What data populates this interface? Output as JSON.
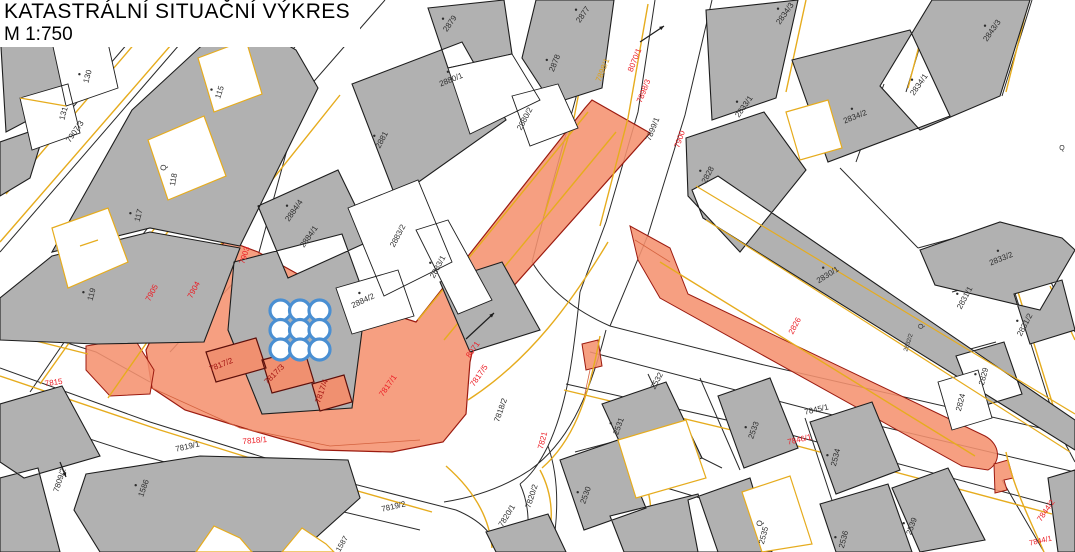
{
  "title": {
    "line1": "KATASTRÁLNÍ SITUAČNÍ VÝKRES",
    "line2": "M 1:750"
  },
  "colors": {
    "background": "#ffffff",
    "building_fill": "#b1b1b1",
    "parcel_line": "#2a2a2a",
    "boundary_yellow": "#e6ac1e",
    "highlight_fill": "#f5926f",
    "highlight_edge": "#9c1b10",
    "highlight_inner_line": "#d4623f",
    "label_black": "#2d2d2d",
    "label_red": "#ec1c24",
    "label_dark_red": "#a31311",
    "label_orange": "#dfa018",
    "symbol_blue": "#4a8fd2"
  },
  "map": {
    "labels": [
      {
        "t": "130",
        "x": 90,
        "y": 77,
        "r": -75,
        "c": "k",
        "d": 1
      },
      {
        "t": "131",
        "x": 66,
        "y": 114,
        "r": -75,
        "c": "k"
      },
      {
        "t": "7907/3",
        "x": 77,
        "y": 133,
        "r": -55,
        "c": "k"
      },
      {
        "t": "115",
        "x": 222,
        "y": 93,
        "r": -72,
        "c": "k",
        "d": 1
      },
      {
        "t": "Q",
        "x": 166,
        "y": 168,
        "r": -80,
        "c": "k"
      },
      {
        "t": "118",
        "x": 176,
        "y": 180,
        "r": -80,
        "c": "k"
      },
      {
        "t": "117",
        "x": 141,
        "y": 216,
        "r": -75,
        "c": "k",
        "d": 1
      },
      {
        "t": "119",
        "x": 94,
        "y": 295,
        "r": -75,
        "c": "k",
        "d": 1
      },
      {
        "t": "2879",
        "x": 452,
        "y": 25,
        "r": -55,
        "c": "k",
        "d": 1
      },
      {
        "t": "2877",
        "x": 585,
        "y": 16,
        "r": -55,
        "c": "k",
        "d": 1
      },
      {
        "t": "2878",
        "x": 557,
        "y": 64,
        "r": -68,
        "c": "k",
        "d": 1
      },
      {
        "t": "2880/1",
        "x": 452,
        "y": 82,
        "r": -22,
        "c": "k",
        "d": 1
      },
      {
        "t": "2880/2",
        "x": 527,
        "y": 120,
        "r": -62,
        "c": "k"
      },
      {
        "t": "2881",
        "x": 384,
        "y": 141,
        "r": -62,
        "c": "k",
        "d": 1
      },
      {
        "t": "2884/4",
        "x": 296,
        "y": 212,
        "r": -55,
        "c": "k",
        "d": 1
      },
      {
        "t": "2884/1",
        "x": 311,
        "y": 238,
        "r": -55,
        "c": "k"
      },
      {
        "t": "2883/2",
        "x": 400,
        "y": 237,
        "r": -62,
        "c": "k"
      },
      {
        "t": "2883/1",
        "x": 440,
        "y": 268,
        "r": -62,
        "c": "k",
        "d": 1
      },
      {
        "t": "2884/2",
        "x": 364,
        "y": 303,
        "r": -25,
        "c": "k",
        "d": 1
      },
      {
        "t": "7899/1",
        "x": 655,
        "y": 130,
        "r": -68,
        "c": "k"
      },
      {
        "t": "2834/3",
        "x": 787,
        "y": 15,
        "r": -55,
        "c": "k",
        "d": 1
      },
      {
        "t": "2833/1",
        "x": 746,
        "y": 108,
        "r": -55,
        "c": "k",
        "d": 1
      },
      {
        "t": "2834/2",
        "x": 856,
        "y": 119,
        "r": -22,
        "c": "k",
        "d": 1
      },
      {
        "t": "2834/1",
        "x": 921,
        "y": 86,
        "r": -55,
        "c": "k",
        "d": 1
      },
      {
        "t": "2843/3",
        "x": 994,
        "y": 32,
        "r": -55,
        "c": "k",
        "d": 1
      },
      {
        "t": "2828",
        "x": 710,
        "y": 176,
        "r": -62,
        "c": "k",
        "d": 1
      },
      {
        "t": "2830/1",
        "x": 829,
        "y": 277,
        "r": -32,
        "c": "k",
        "d": 1
      },
      {
        "t": "2833/2",
        "x": 1002,
        "y": 261,
        "r": -22,
        "c": "k",
        "d": 1
      },
      {
        "t": "2831/1",
        "x": 967,
        "y": 299,
        "r": -62,
        "c": "k",
        "d": 1
      },
      {
        "t": "2831/2",
        "x": 1027,
        "y": 326,
        "r": -62,
        "c": "k",
        "d": 1
      },
      {
        "t": "Q",
        "x": 923,
        "y": 327,
        "r": -72,
        "c": "k",
        "s": 7
      },
      {
        "t": "2832/2",
        "x": 910,
        "y": 343,
        "r": -72,
        "c": "k",
        "s": 6
      },
      {
        "t": "2829",
        "x": 986,
        "y": 377,
        "r": -75,
        "c": "k",
        "d": 1
      },
      {
        "t": "2824",
        "x": 963,
        "y": 403,
        "r": -75,
        "c": "k"
      },
      {
        "t": "Q",
        "x": 1062,
        "y": 150,
        "r": 0,
        "c": "k",
        "s": 7
      },
      {
        "t": "7845/1",
        "x": 817,
        "y": 412,
        "r": -13,
        "c": "k"
      },
      {
        "t": "2534",
        "x": 838,
        "y": 458,
        "r": -75,
        "c": "k",
        "d": 1
      },
      {
        "t": "Q",
        "x": 762,
        "y": 524,
        "r": -75,
        "c": "k"
      },
      {
        "t": "2535",
        "x": 766,
        "y": 536,
        "r": -75,
        "c": "k"
      },
      {
        "t": "2536",
        "x": 846,
        "y": 540,
        "r": -75,
        "c": "k",
        "d": 1
      },
      {
        "t": "2539",
        "x": 914,
        "y": 527,
        "r": -70,
        "c": "k",
        "d": 1
      },
      {
        "t": "2533",
        "x": 756,
        "y": 431,
        "r": -70,
        "c": "k",
        "d": 1
      },
      {
        "t": "2532",
        "x": 659,
        "y": 382,
        "r": -62,
        "c": "k"
      },
      {
        "t": "2531",
        "x": 621,
        "y": 427,
        "r": -70,
        "c": "k",
        "d": 1
      },
      {
        "t": "2530",
        "x": 588,
        "y": 496,
        "r": -70,
        "c": "k",
        "d": 1
      },
      {
        "t": "7818/2",
        "x": 503,
        "y": 411,
        "r": -70,
        "c": "k"
      },
      {
        "t": "7820/1",
        "x": 509,
        "y": 517,
        "r": -58,
        "c": "k"
      },
      {
        "t": "7820/2",
        "x": 534,
        "y": 497,
        "r": -72,
        "c": "k"
      },
      {
        "t": "7819/1",
        "x": 188,
        "y": 449,
        "r": -13,
        "c": "k"
      },
      {
        "t": "7819/2",
        "x": 394,
        "y": 509,
        "r": -13,
        "c": "k"
      },
      {
        "t": "7809/2",
        "x": 62,
        "y": 481,
        "r": -72,
        "c": "k"
      },
      {
        "t": "1586",
        "x": 146,
        "y": 489,
        "r": -70,
        "c": "k",
        "d": 1
      },
      {
        "t": "1587",
        "x": 344,
        "y": 545,
        "r": -60,
        "c": "k",
        "s": 7.5
      },
      {
        "t": "7903",
        "x": 247,
        "y": 256,
        "r": -72,
        "c": "r"
      },
      {
        "t": "7904",
        "x": 196,
        "y": 291,
        "r": -62,
        "c": "r"
      },
      {
        "t": "7905",
        "x": 154,
        "y": 294,
        "r": -62,
        "c": "r"
      },
      {
        "t": "7815",
        "x": 54,
        "y": 385,
        "r": -8,
        "c": "r"
      },
      {
        "t": "7818/1",
        "x": 255,
        "y": 443,
        "r": -5,
        "c": "r"
      },
      {
        "t": "7898/3",
        "x": 646,
        "y": 92,
        "r": -68,
        "c": "r"
      },
      {
        "t": "8070/1",
        "x": 637,
        "y": 61,
        "r": -68,
        "c": "r"
      },
      {
        "t": "7900",
        "x": 682,
        "y": 140,
        "r": -70,
        "c": "r"
      },
      {
        "t": "8071",
        "x": 475,
        "y": 351,
        "r": -55,
        "c": "r"
      },
      {
        "t": "7817/5",
        "x": 481,
        "y": 377,
        "r": -55,
        "c": "r"
      },
      {
        "t": "7817/1",
        "x": 390,
        "y": 387,
        "r": -55,
        "c": "r"
      },
      {
        "t": "7821",
        "x": 545,
        "y": 441,
        "r": -75,
        "c": "r"
      },
      {
        "t": "2826",
        "x": 797,
        "y": 327,
        "r": -62,
        "c": "r"
      },
      {
        "t": "7846/1",
        "x": 800,
        "y": 442,
        "r": -13,
        "c": "r"
      },
      {
        "t": "7844/2",
        "x": 1048,
        "y": 512,
        "r": -55,
        "c": "r"
      },
      {
        "t": "7844/1",
        "x": 1041,
        "y": 543,
        "r": -13,
        "c": "r",
        "s": 7.5
      },
      {
        "t": "7817/2",
        "x": 222,
        "y": 367,
        "r": -22,
        "c": "m"
      },
      {
        "t": "7817/3",
        "x": 276,
        "y": 376,
        "r": -45,
        "c": "m"
      },
      {
        "t": "7817/4",
        "x": 324,
        "y": 392,
        "r": -70,
        "c": "m"
      },
      {
        "t": "7898/1",
        "x": 605,
        "y": 71,
        "r": -68,
        "c": "o"
      }
    ],
    "symbols": {
      "circle_grid": {
        "name": "circle-grid-symbol",
        "cx": 300,
        "cy": 330,
        "rows": 3,
        "cols": 3,
        "radius": 10.5,
        "spacing": 19.5
      },
      "arrows": [
        {
          "x1": 640,
          "y1": 42,
          "x2": 664,
          "y2": 26
        },
        {
          "x1": 466,
          "y1": 339,
          "x2": 494,
          "y2": 313
        },
        {
          "x1": 60,
          "y1": 462,
          "x2": 66,
          "y2": 477
        }
      ]
    }
  }
}
